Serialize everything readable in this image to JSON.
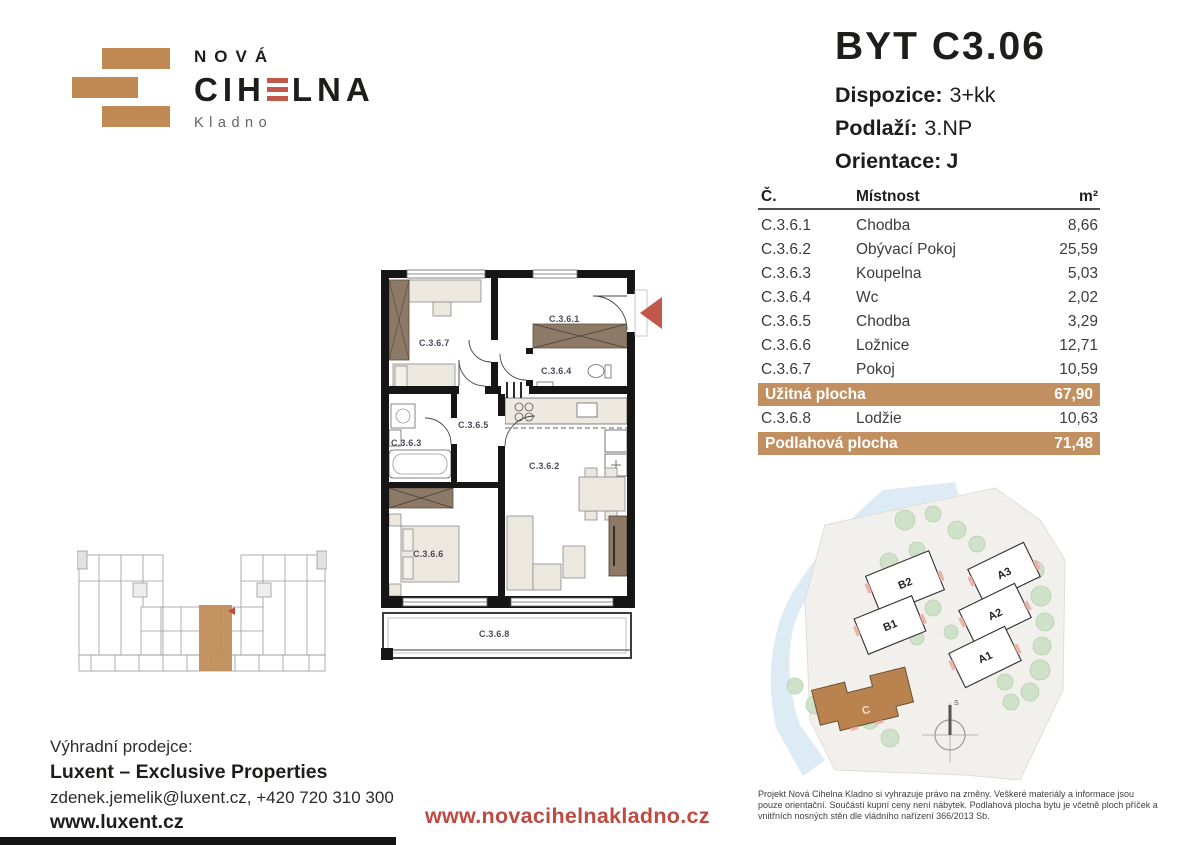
{
  "logo": {
    "top_text": "NOVÁ",
    "name_full": "CIHELNA",
    "name_left": "CIH",
    "name_right": "LNA",
    "subtitle": "Kladno"
  },
  "unit": {
    "title": "BYT C3.06",
    "specs": [
      {
        "label": "Dispozice:",
        "value": "3+kk"
      },
      {
        "label": "Podlaží:",
        "value": "3.NP"
      },
      {
        "label": "Orientace:",
        "value": "J"
      }
    ]
  },
  "room_table": {
    "header": {
      "code": "Č.",
      "room": "Místnost",
      "area": "m²"
    },
    "rows": [
      {
        "code": "C.3.6.1",
        "name": "Chodba",
        "area": "8,66"
      },
      {
        "code": "C.3.6.2",
        "name": "Obývací Pokoj",
        "area": "25,59"
      },
      {
        "code": "C.3.6.3",
        "name": "Koupelna",
        "area": "5,03"
      },
      {
        "code": "C.3.6.4",
        "name": "Wc",
        "area": "2,02"
      },
      {
        "code": "C.3.6.5",
        "name": "Chodba",
        "area": "3,29"
      },
      {
        "code": "C.3.6.6",
        "name": "Ložnice",
        "area": "12,71"
      },
      {
        "code": "C.3.6.7",
        "name": "Pokoj",
        "area": "10,59"
      }
    ],
    "usable": {
      "label": "Užitná plocha",
      "value": "67,90"
    },
    "loggia": {
      "code": "C.3.6.8",
      "name": "Lodžie",
      "area": "10,63"
    },
    "floor_total": {
      "label": "Podlahová plocha",
      "value": "71,48"
    }
  },
  "floorplan": {
    "labels": {
      "c361": "C.3.6.1",
      "c362": "C.3.6.2",
      "c363": "C.3.6.3",
      "c364": "C.3.6.4",
      "c365": "C.3.6.5",
      "c366": "C.3.6.6",
      "c367": "C.3.6.7",
      "c368": "C.3.6.8"
    }
  },
  "siteplan": {
    "buildings": {
      "b2": "B2",
      "b1": "B1",
      "a3": "A3",
      "a2": "A2",
      "a1": "A1",
      "c": "C"
    },
    "compass": "S"
  },
  "footer": {
    "seller_label": "Výhradní prodejce:",
    "seller_name": "Luxent – Exclusive Properties",
    "contact": "zdenek.jemelik@luxent.cz, +420 720 310 300",
    "seller_web": "www.luxent.cz",
    "project_web": "www.novacihelnakladno.cz",
    "disclaimer": "Projekt Nová Cihelna Kladno si vyhrazuje právo na změny. Veškeré materiály a informace jsou pouze orientační. Součástí kupní ceny není nábytek. Podlahová plocha bytu je včetně ploch příček a vnitřních nosných stěn dle vládního nařízení 366/2013 Sb."
  },
  "colors": {
    "brand_tan": "#C18A54",
    "brand_red": "#C2584A",
    "table_highlight": "#C29060",
    "link_red": "#BF4A42",
    "site_building_c": "#B9824F"
  }
}
